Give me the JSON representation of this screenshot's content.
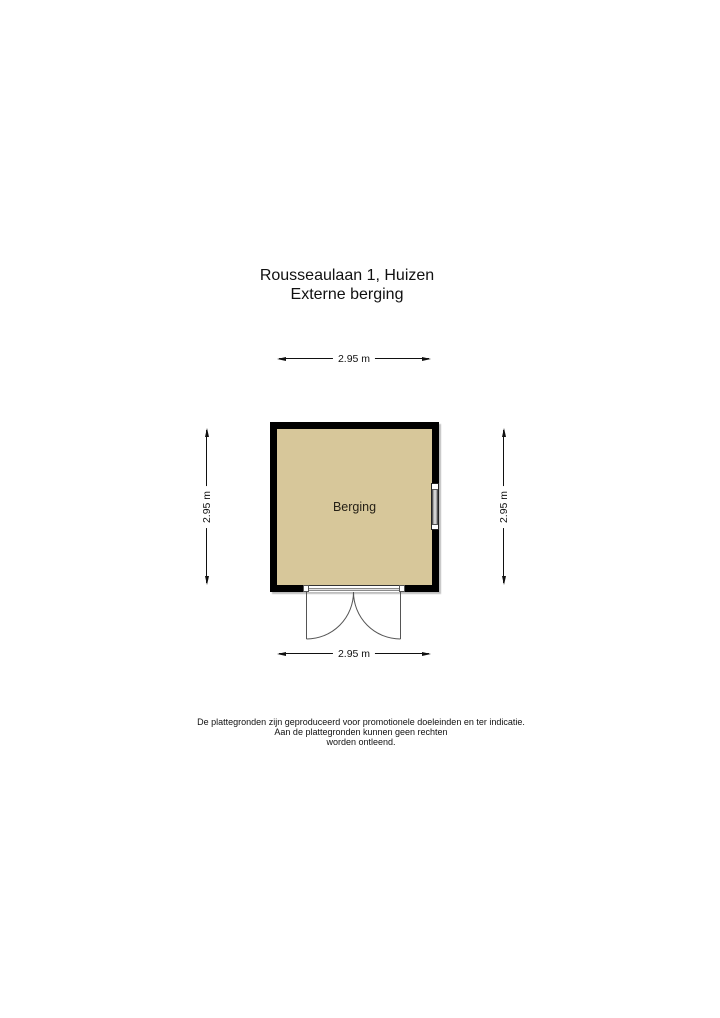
{
  "title": {
    "line1": "Rousseaulaan 1, Huizen",
    "line2": "Externe berging"
  },
  "floorplan": {
    "room_label": "Berging",
    "dimensions": {
      "top": "2.95 m",
      "bottom": "2.95 m",
      "left": "2.95 m",
      "right": "2.95 m"
    },
    "colors": {
      "room_fill": "#d7c79a",
      "wall": "#000000",
      "dimension_line": "#111111"
    }
  },
  "footer": {
    "line1": "De plattegronden zijn geproduceerd voor promotionele doeleinden en ter indicatie.",
    "line2": "Aan de plattegronden kunnen geen rechten",
    "line3": "worden ontleend."
  }
}
